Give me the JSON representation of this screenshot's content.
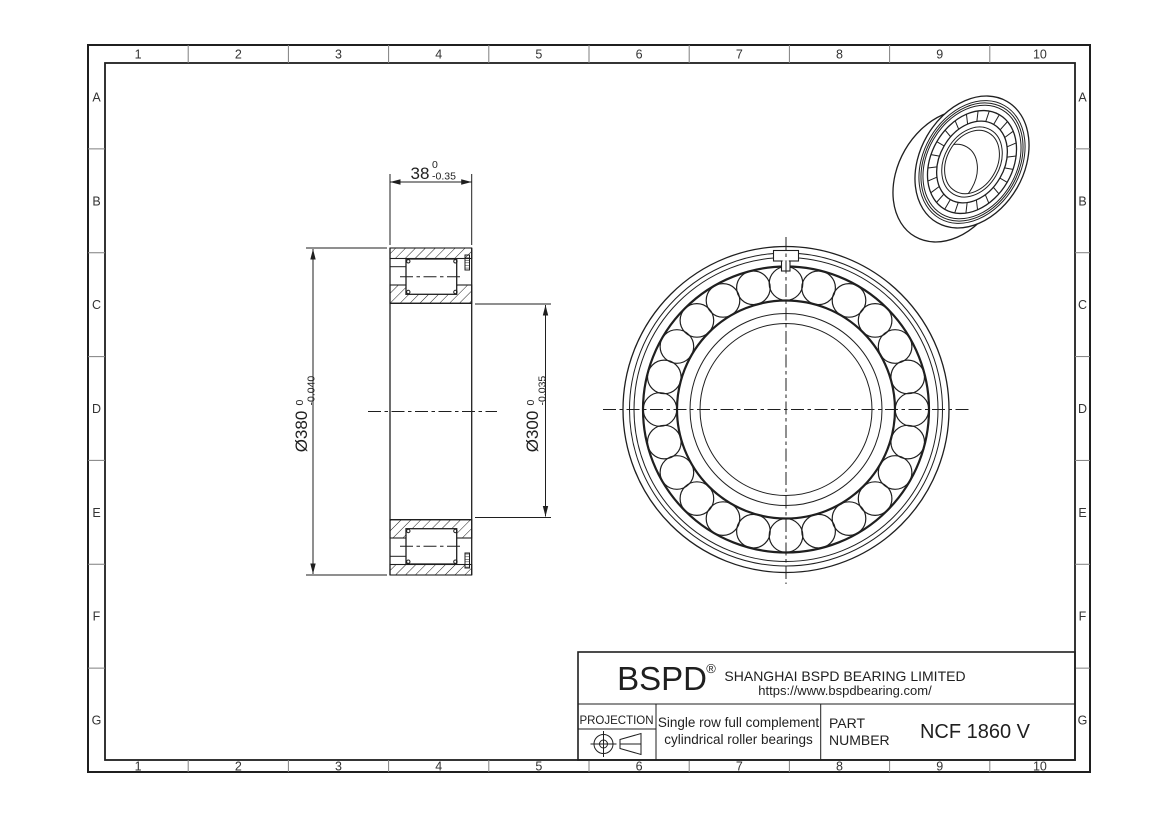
{
  "sheet": {
    "grid": {
      "columns": [
        "1",
        "2",
        "3",
        "4",
        "5",
        "6",
        "7",
        "8",
        "9",
        "10"
      ],
      "rows": [
        "A",
        "B",
        "C",
        "D",
        "E",
        "F",
        "G"
      ]
    },
    "dimensions": {
      "width": {
        "value": "38",
        "tol_upper": "0",
        "tol_lower": "-0.35"
      },
      "outer_diameter": {
        "value": "Ø380",
        "tol_upper": "0",
        "tol_lower": "-0.040"
      },
      "bore_diameter": {
        "value": "Ø300",
        "tol_upper": "0",
        "tol_lower": "-0.035"
      }
    },
    "title_block": {
      "brand": "BSPD",
      "registered_mark": "®",
      "company": "SHANGHAI BSPD BEARING LIMITED",
      "website": "https://www.bspdbearing.com/",
      "projection_label": "PROJECTION",
      "description_line1": "Single row full complement",
      "description_line2": "cylindrical roller bearings",
      "part_label_line1": "PART",
      "part_label_line2": "NUMBER",
      "part_number": "NCF 1860 V"
    },
    "colors": {
      "line": "#1f1f1f",
      "grid_line": "#7f7f7f",
      "background": "#ffffff"
    }
  }
}
